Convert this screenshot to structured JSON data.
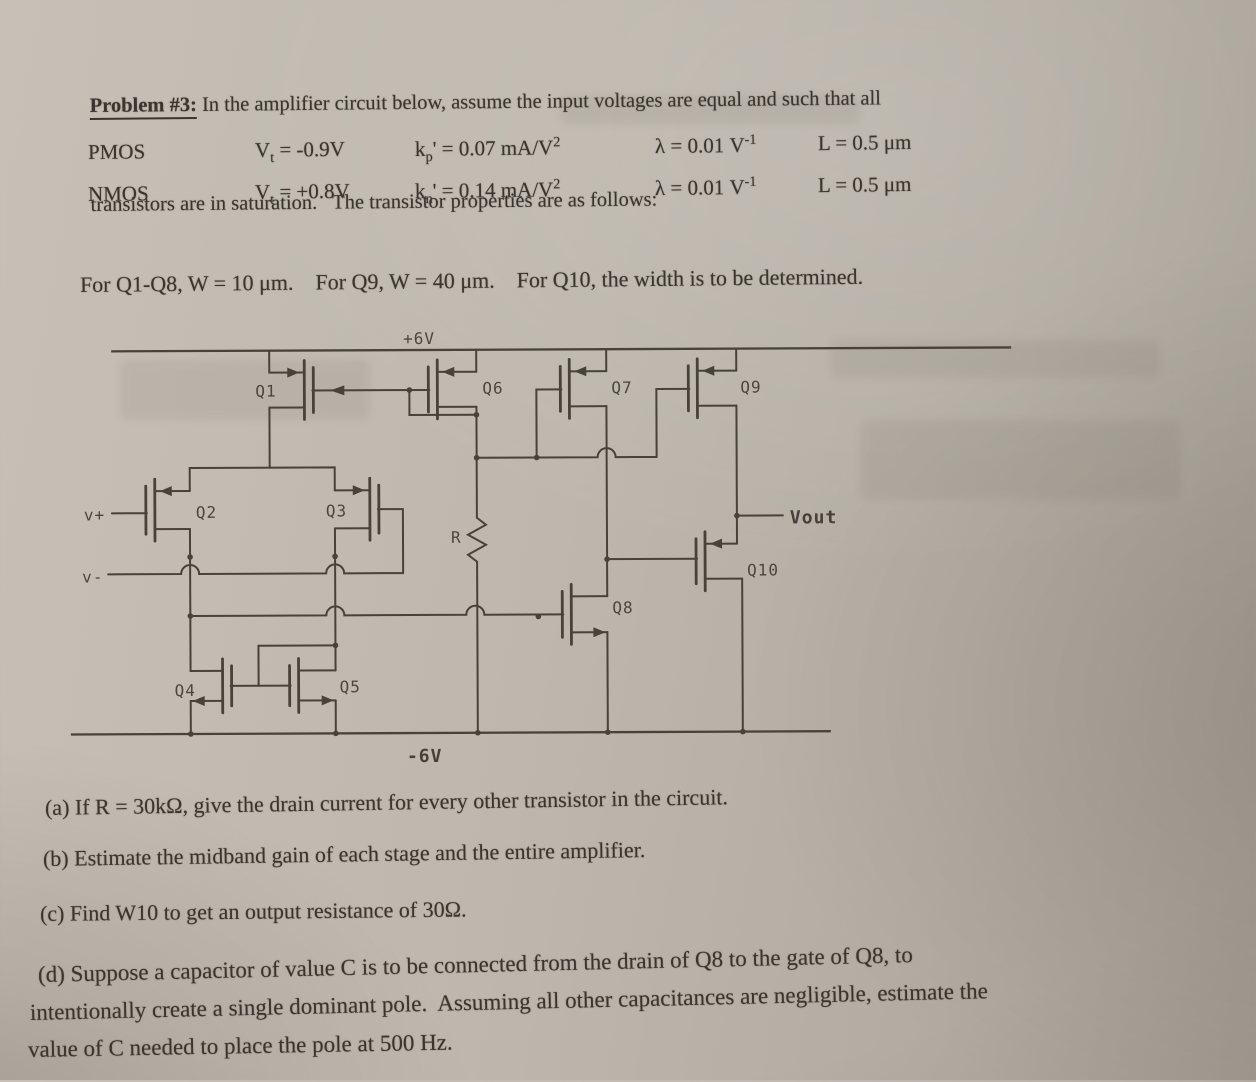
{
  "header": {
    "problem_label": "Problem #3:",
    "intro_line1": " In the amplifier circuit below, assume the input voltages are equal and such that all",
    "intro_line2": "transistors are in saturation.   The transistor properties are as follows:"
  },
  "properties_table": {
    "rows": [
      {
        "cells": [
          [
            {
              "t": "PMOS"
            }
          ],
          [
            {
              "t": "V"
            },
            {
              "s": "t"
            },
            {
              "t": " = -0.9V"
            }
          ],
          [
            {
              "t": "k"
            },
            {
              "s": "p"
            },
            {
              "t": "' = 0.07 mA/V"
            },
            {
              "p": "2"
            }
          ],
          [
            {
              "t": "λ = 0.01 V"
            },
            {
              "p": "-1"
            }
          ],
          [
            {
              "t": "L = 0.5 μm"
            }
          ]
        ]
      },
      {
        "cells": [
          [
            {
              "t": "NMOS"
            }
          ],
          [
            {
              "t": "V"
            },
            {
              "s": "t"
            },
            {
              "t": " = +0.8V"
            }
          ],
          [
            {
              "t": "k"
            },
            {
              "s": "n"
            },
            {
              "t": "' = 0.14 mA/V"
            },
            {
              "p": "2"
            }
          ],
          [
            {
              "t": "λ = 0.01 V"
            },
            {
              "p": "-1"
            }
          ],
          [
            {
              "t": "L = 0.5 μm"
            }
          ]
        ]
      }
    ]
  },
  "width_note": "For Q1-Q8, W = 10 μm.    For Q9, W = 40 μm.    For Q10, the width is to be determined.",
  "circuit": {
    "rail_top_label": "+6V",
    "rail_bottom_label": "-6V",
    "input_plus_label": "v+",
    "input_minus_label": "v-",
    "resistor_label": "R",
    "output_label": "Vout",
    "transistors": [
      {
        "label": "Q1"
      },
      {
        "label": "Q2"
      },
      {
        "label": "Q3"
      },
      {
        "label": "Q4"
      },
      {
        "label": "Q5"
      },
      {
        "label": "Q6"
      },
      {
        "label": "Q7"
      },
      {
        "label": "Q8"
      },
      {
        "label": "Q9"
      },
      {
        "label": "Q10"
      }
    ]
  },
  "questions": {
    "a": "(a) If R = 30kΩ, give the drain current for every other transistor in the circuit.",
    "b": "(b) Estimate the midband gain of each stage and the entire amplifier.",
    "c": "(c) Find W10 to get an output resistance of 30Ω.",
    "d1": "(d) Suppose a capacitor of value C is to be connected from the drain of Q8 to the gate of Q8, to",
    "d2": "intentionally create a single dominant pole.  Assuming all other capacitances are negligible, estimate the",
    "d3": "value of C needed to place the pole at 500 Hz."
  }
}
